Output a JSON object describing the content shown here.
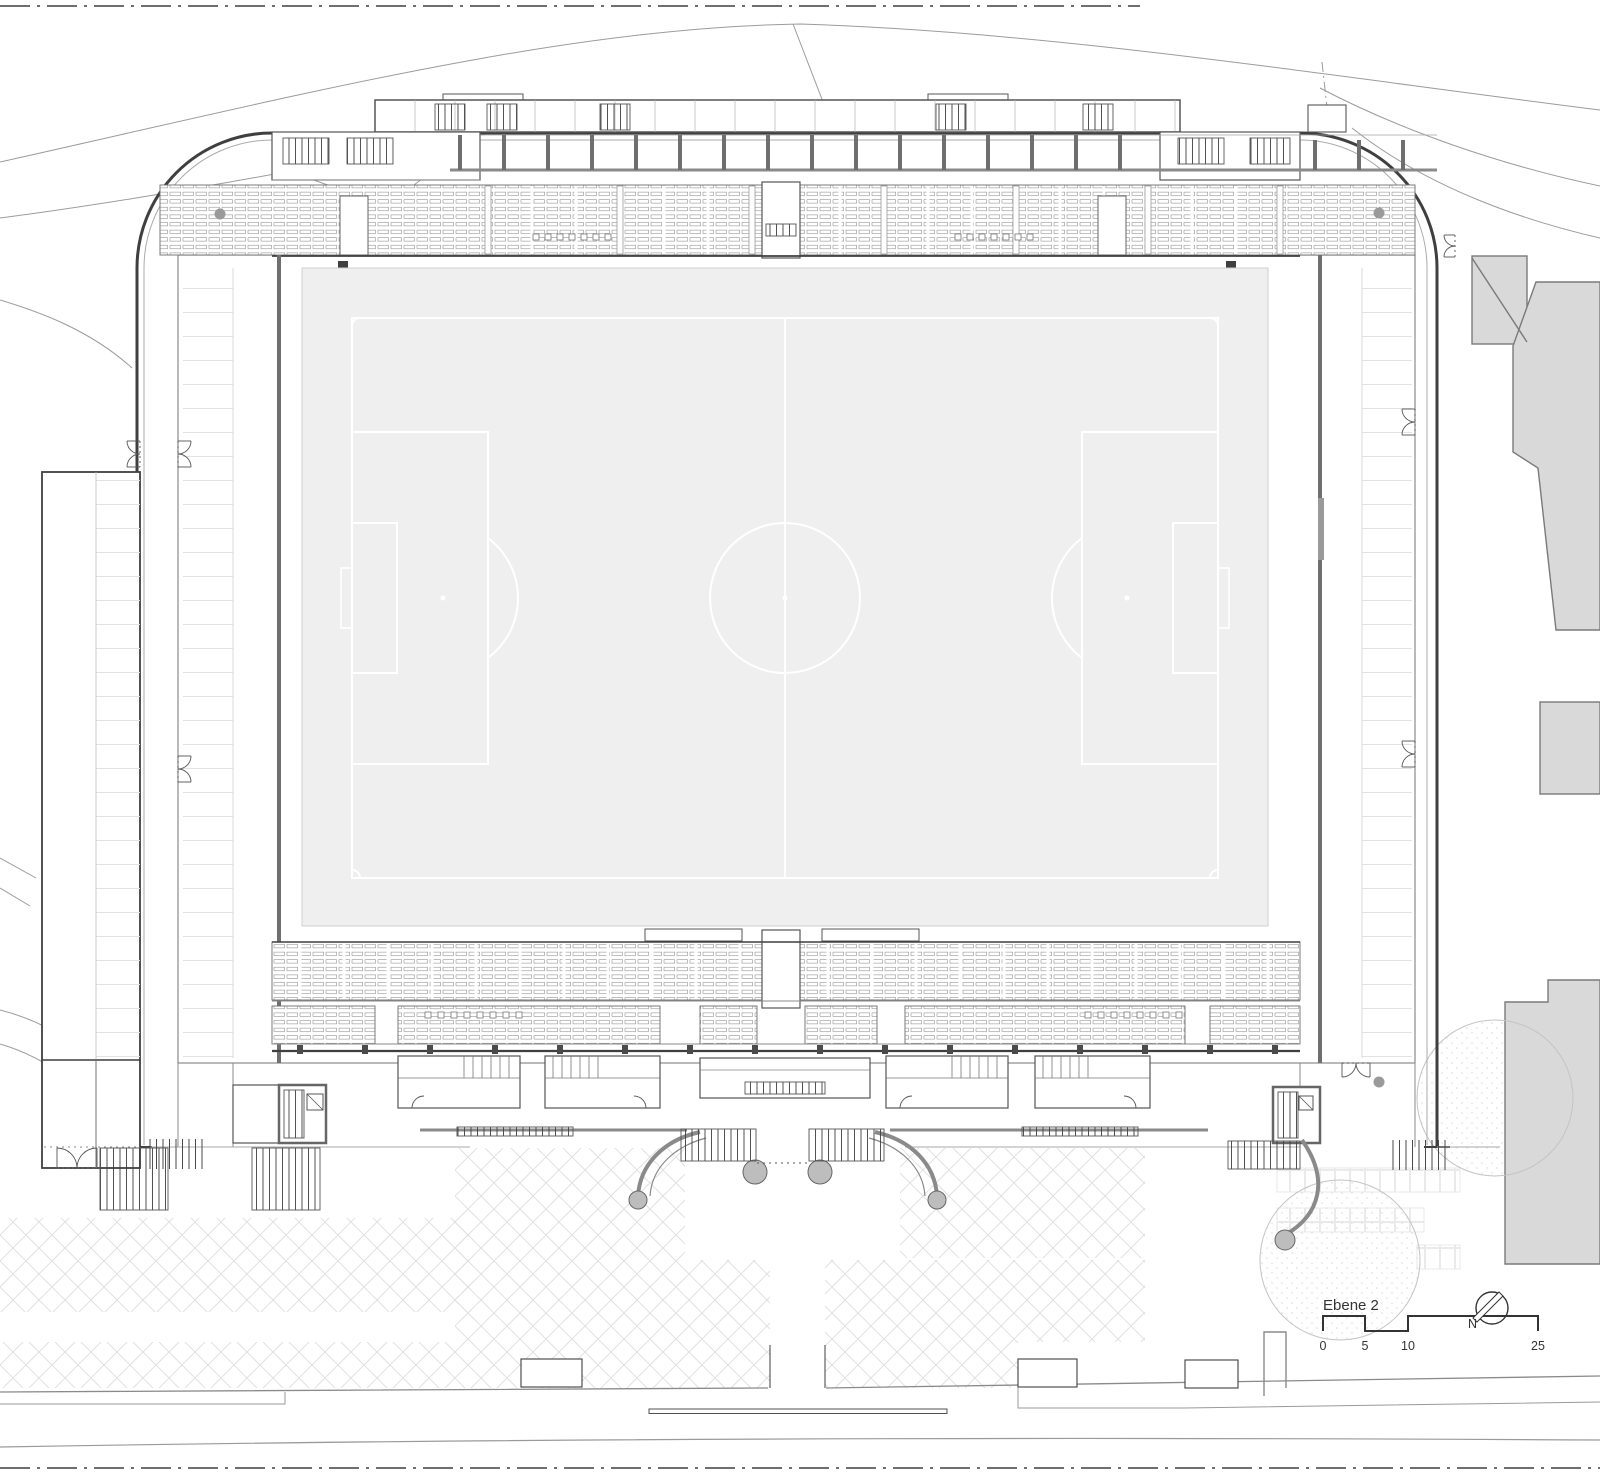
{
  "plan": {
    "level_label": "Ebene 2",
    "north_label": "N",
    "scale_ticks": [
      "0",
      "5",
      "10",
      "25"
    ]
  },
  "colors": {
    "ink": "#3f3f3f",
    "wall": "#8a8a8a",
    "mid": "#9a9a9a",
    "faint": "#e2e2e2",
    "pitch_fill": "#efefef",
    "pitch_line": "#ffffff",
    "building_fill": "#d9d9d9",
    "pad_fill": "#bdbdbd",
    "paving": "#dedede",
    "tree_outline": "#c4c4c4"
  }
}
